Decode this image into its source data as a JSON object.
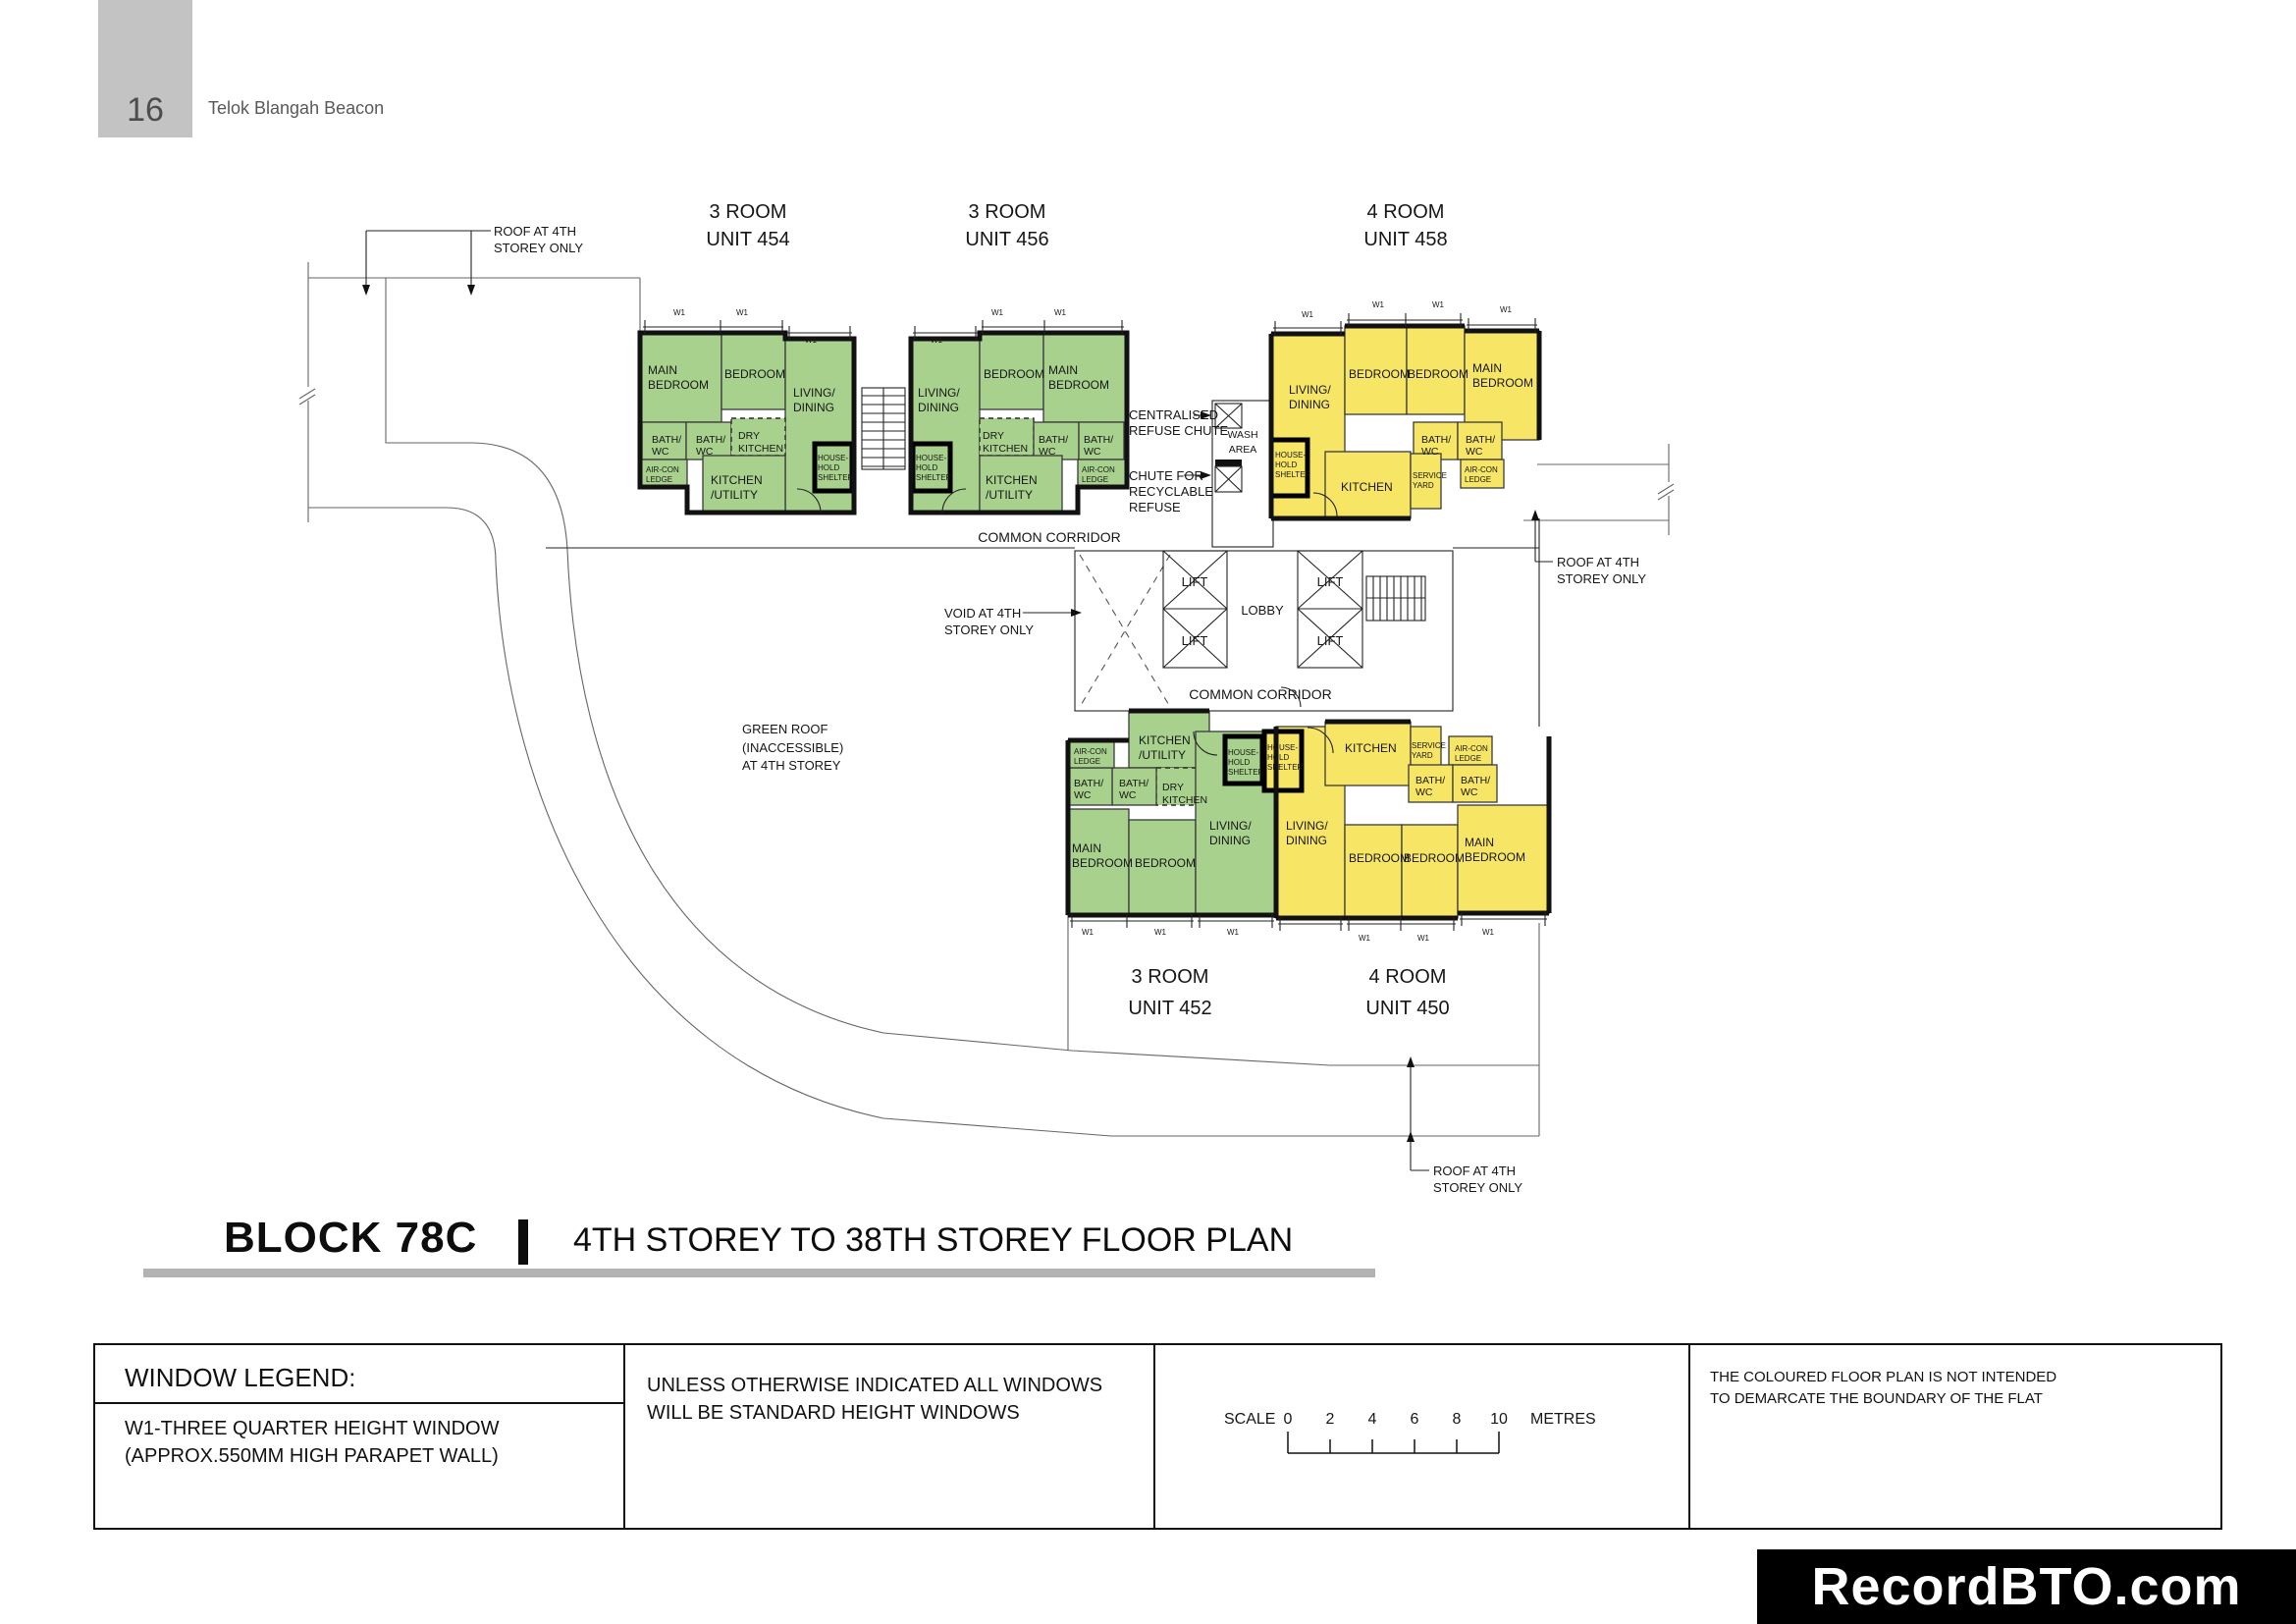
{
  "page": {
    "number": "16",
    "project": "Telok Blangah Beacon"
  },
  "title": {
    "block": "BLOCK 78C",
    "subtitle": "4TH STOREY TO 38TH STOREY FLOOR PLAN"
  },
  "units": [
    {
      "type": "3 ROOM",
      "unit": "UNIT 454"
    },
    {
      "type": "3 ROOM",
      "unit": "UNIT 456"
    },
    {
      "type": "4 ROOM",
      "unit": "UNIT 458"
    },
    {
      "type": "3 ROOM",
      "unit": "UNIT 452"
    },
    {
      "type": "4 ROOM",
      "unit": "UNIT 450"
    }
  ],
  "rooms": {
    "main1": "MAIN",
    "main2": "BEDROOM",
    "bed": "BEDROOM",
    "liv1": "LIVING/",
    "liv2": "DINING",
    "bath1": "BATH/",
    "bath2": "WC",
    "dry1": "DRY",
    "dry2": "KITCHEN",
    "ku1": "KITCHEN",
    "ku2": "/UTILITY",
    "kit": "KITCHEN",
    "sy1": "SERVICE",
    "sy2": "YARD",
    "ac1": "AIR-CON",
    "ac2": "LEDGE",
    "hh1": "HOUSE-",
    "hh2": "HOLD",
    "hh3": "SHELTER",
    "w1": "W1"
  },
  "core": {
    "lift": "LIFT",
    "lobby": "LOBBY",
    "corridor": "COMMON CORRIDOR",
    "wash1": "WASH",
    "wash2": "AREA"
  },
  "ann": {
    "roof1": "ROOF AT 4TH",
    "roof2": "STOREY ONLY",
    "cen1": "CENTRALISED",
    "cen2": "REFUSE CHUTE",
    "rec1": "CHUTE FOR",
    "rec2": "RECYCLABLE",
    "rec3": "REFUSE",
    "void1": "VOID AT 4TH",
    "void2": "STOREY ONLY",
    "gr1": "GREEN ROOF",
    "gr2": "(INACCESSIBLE)",
    "gr3": "AT 4TH STOREY"
  },
  "legend": {
    "heading": "WINDOW LEGEND:",
    "w1_line1": "W1-THREE QUARTER HEIGHT WINDOW",
    "w1_line2": "(APPROX.550MM HIGH PARAPET WALL)",
    "note1": "UNLESS OTHERWISE INDICATED ALL WINDOWS",
    "note2": "WILL BE STANDARD HEIGHT WINDOWS",
    "scale_label": "SCALE",
    "ticks": [
      "0",
      "2",
      "4",
      "6",
      "8",
      "10"
    ],
    "unit_label": "METRES",
    "disc1": "THE COLOURED FLOOR PLAN IS NOT INTENDED",
    "disc2": "TO DEMARCATE THE BOUNDARY OF THE FLAT"
  },
  "watermark": "RecordBTO.com",
  "colors": {
    "unit_green": "#a9d18e",
    "unit_yellow": "#f7e565",
    "header_gray": "#c3c3c3",
    "bar_gray": "#b3b3b3",
    "wall": "#141414"
  }
}
